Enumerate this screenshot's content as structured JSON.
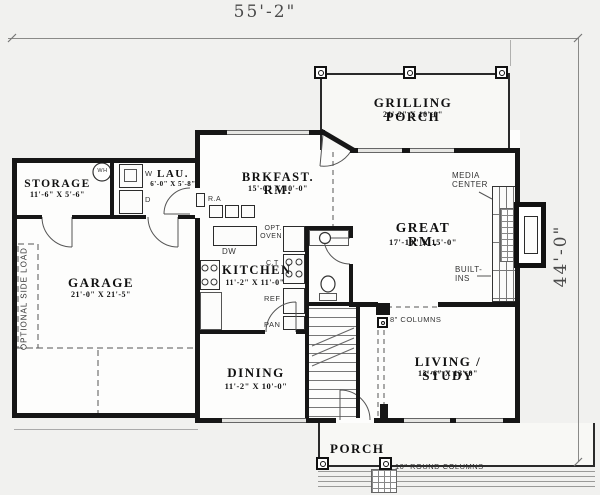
{
  "dims": {
    "width_label": "55'-2\"",
    "height_label": "44'-0\""
  },
  "rooms": {
    "grilling_porch": {
      "name": "GRILLING PORCH",
      "size": "21'-2\" X 10'-0\""
    },
    "storage": {
      "name": "STORAGE",
      "size": "11'-6\" X 5'-6\""
    },
    "laundry": {
      "name": "LAU.",
      "size": "6'-0\" X 5'-8\""
    },
    "breakfast": {
      "name": "BRKFAST. RM.",
      "size": "15'-0\" X 10'-0\""
    },
    "great_room": {
      "name": "GREAT RM.",
      "size": "17'-10\" X 15'-0\""
    },
    "garage": {
      "name": "GARAGE",
      "size": "21'-0\" X 21'-5\""
    },
    "kitchen": {
      "name": "KITCHEN",
      "size": "11'-2\" X 11'-0\""
    },
    "dining": {
      "name": "DINING",
      "size": "11'-2\" X 10'-0\""
    },
    "living_study": {
      "name": "LIVING / STUDY",
      "size": "13'-6\" X 13'-0\""
    },
    "porch": {
      "name": "PORCH"
    }
  },
  "labels": {
    "media_center": "MEDIA\nCENTER",
    "built_ins": "BUILT-\nINS",
    "optional_side_load": "OPTIONAL SIDE LOAD",
    "columns8": "8\" COLUMNS",
    "round_columns": "10\" ROUND COLUMNS",
    "wh": "WH",
    "washer": "W",
    "dryer": "D",
    "dw": "DW",
    "opt_oven": "OPT.\nOVEN",
    "cooktop": "C.T",
    "ref": "REF",
    "pan": "PAN",
    "ra": "R.A"
  },
  "colors": {
    "ink": "#161616",
    "paper": "#f1f1ef",
    "window_fill": "#e6e6e3"
  }
}
